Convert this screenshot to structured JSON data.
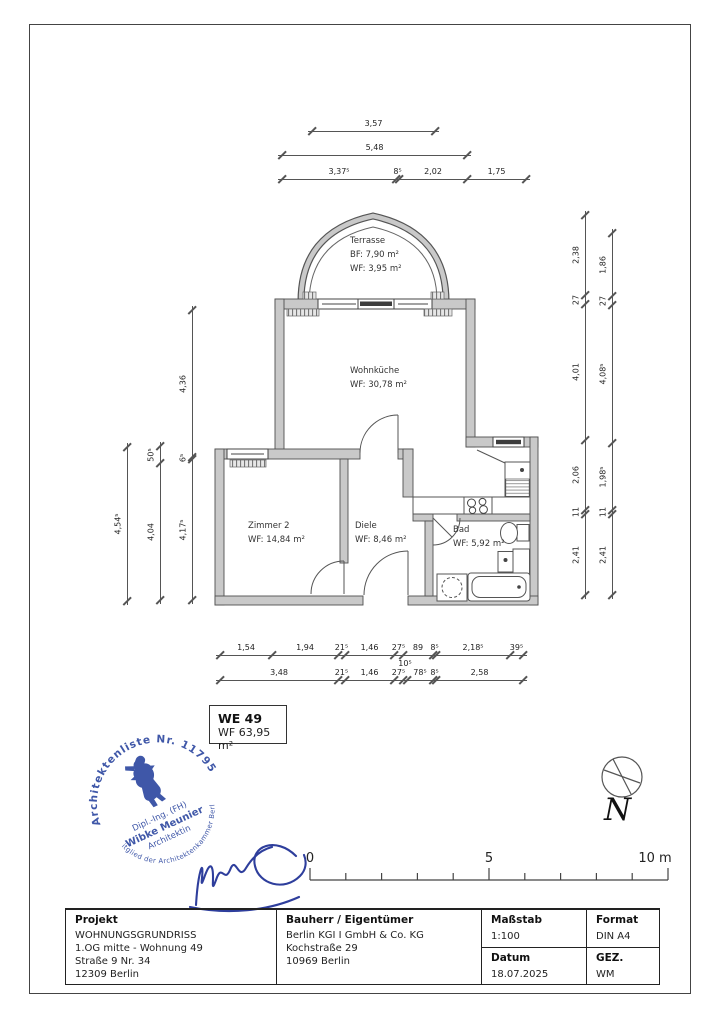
{
  "rooms": {
    "terrasse": {
      "name": "Terrasse",
      "line1": "BF: 7,90 m²",
      "line2": "WF: 3,95 m²"
    },
    "wohnkueche": {
      "name": "Wohnküche",
      "line1": "WF: 30,78 m²"
    },
    "zimmer2": {
      "name": "Zimmer 2",
      "line1": "WF: 14,84 m²"
    },
    "diele": {
      "name": "Diele",
      "line1": "WF: 8,46 m²"
    },
    "bad": {
      "name": "Bad",
      "line1": "WF: 5,92 m²"
    }
  },
  "dimensions": {
    "top": [
      [
        "3,57"
      ],
      [
        "5,48"
      ],
      [
        "3,37⁵",
        "8⁵",
        "2,02",
        "1,75"
      ]
    ],
    "left": [
      [
        "4,54⁵"
      ],
      [
        "50⁵",
        "4,04"
      ],
      [
        "4,36",
        "6⁵",
        "4,17⁵"
      ]
    ],
    "right": [
      [
        "2,38",
        "27",
        "4,01",
        "2,06",
        "11",
        "2,41"
      ],
      [
        "1,86",
        "27",
        "4,08⁵",
        "1,98⁵",
        "11",
        "2,41"
      ]
    ],
    "bottom": [
      [
        "1,54",
        "1,94",
        "21⁵",
        "1,46",
        "27⁵",
        "89",
        "8⁵",
        "2,18⁵",
        "39⁵"
      ],
      [
        "3,48",
        "21⁵",
        "1,46",
        "27⁵",
        "10⁵",
        "78⁵",
        "8⁵",
        "2,58"
      ]
    ]
  },
  "we_box": {
    "id": "WE 49",
    "area": "WF 63,95 m²"
  },
  "stamp": {
    "ring_top": "● Architektenliste Nr. 11795 ●",
    "ring_bottom": "Mitglied der Architektenkammer Berlin",
    "title": "Dipl.-Ing. (FH)",
    "name": "Wibke Meunier",
    "role": "Architektin",
    "color": "#3f57a8"
  },
  "north": {
    "label": "N"
  },
  "scalebar": {
    "labels": [
      "0",
      "5",
      "10 m"
    ]
  },
  "titleblock": {
    "projekt": {
      "header": "Projekt",
      "line1": "WOHNUNGSGRUNDRISS",
      "line2": "1.OG mitte - Wohnung 49",
      "line3": "Straße 9 Nr. 34",
      "line4": "12309 Berlin"
    },
    "bauherr": {
      "header": "Bauherr / Eigentümer",
      "line1": "Berlin KGI I GmbH & Co. KG",
      "line2": "Kochstraße 29",
      "line3": "10969 Berlin"
    },
    "massstab": {
      "header": "Maßstab",
      "value": "1:100"
    },
    "format": {
      "header": "Format",
      "value": "DIN A4"
    },
    "datum": {
      "header": "Datum",
      "value": "18.07.2025"
    },
    "gez": {
      "header": "GEZ.",
      "value": "WM"
    }
  }
}
